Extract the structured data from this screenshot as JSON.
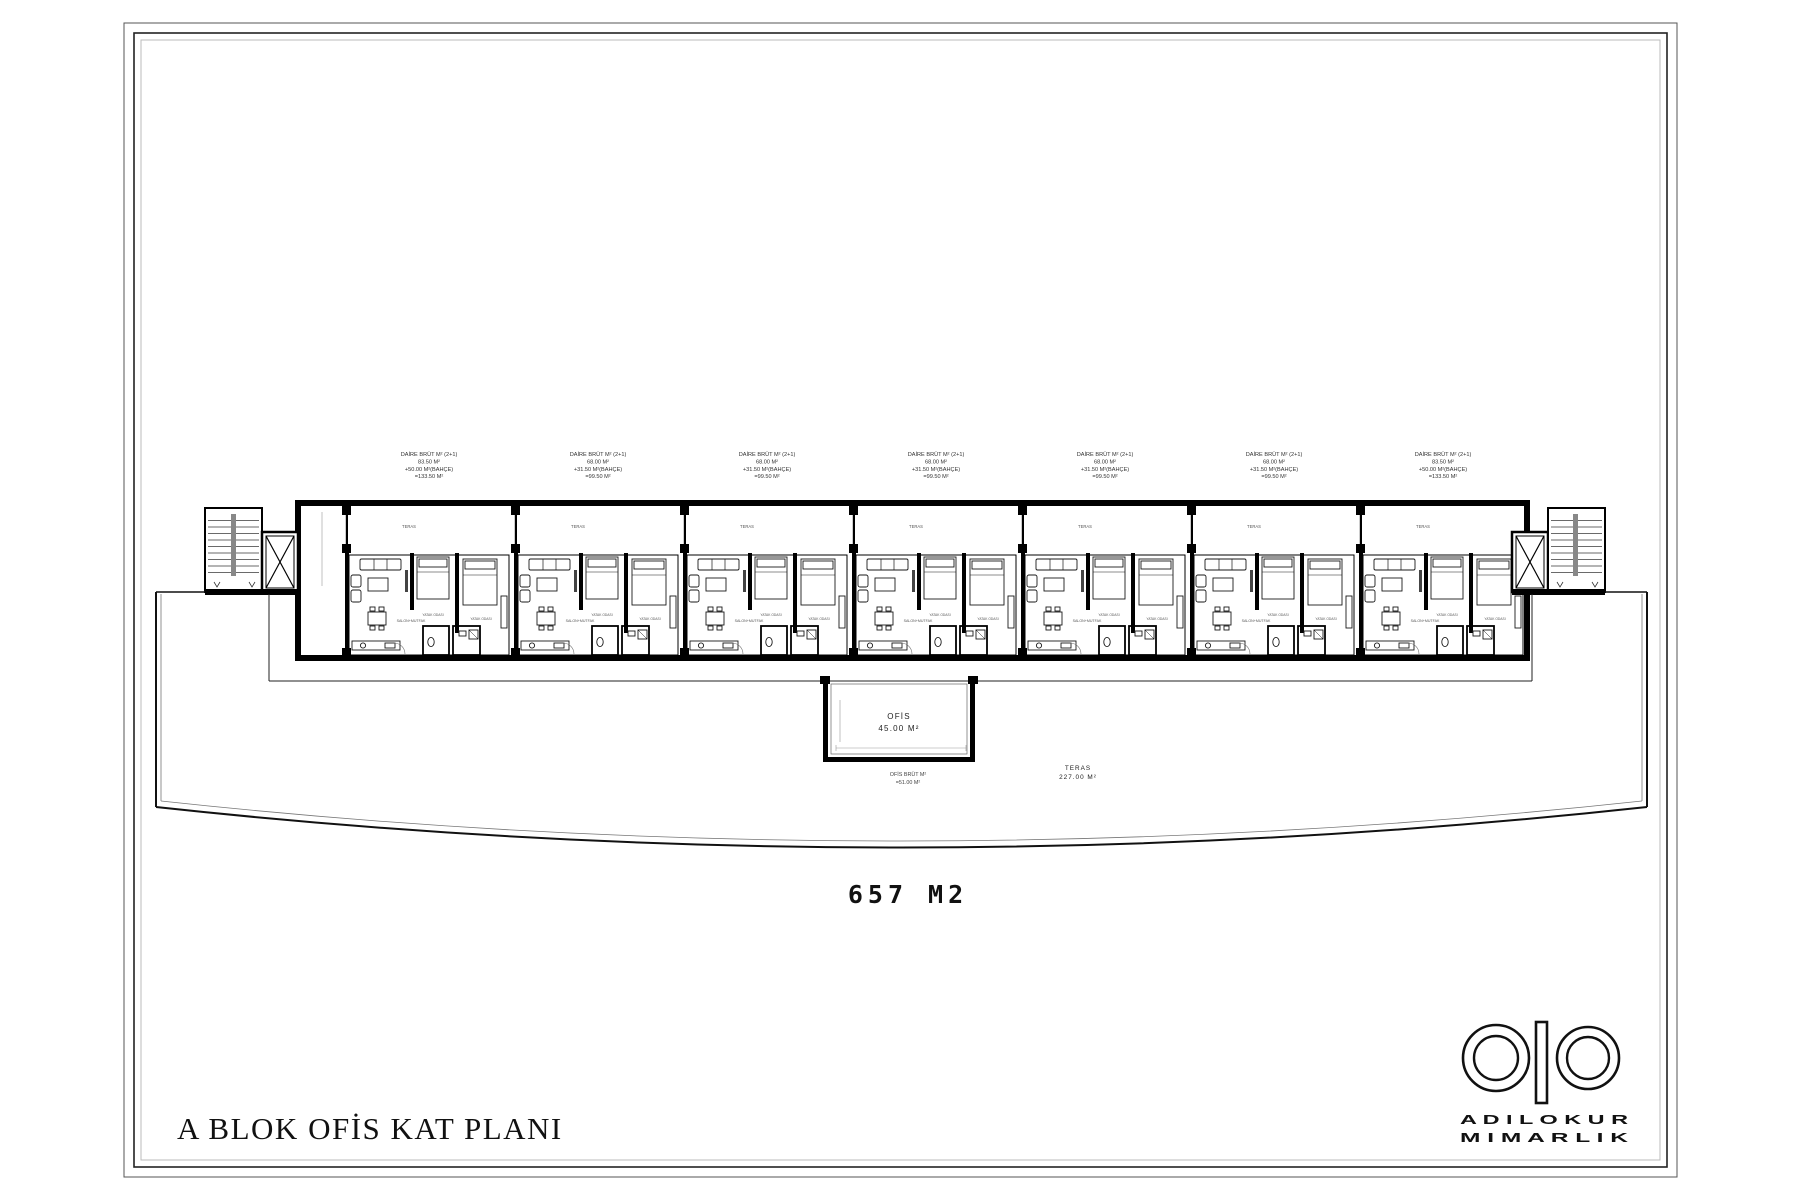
{
  "page": {
    "title": "A BLOK OFİS KAT PLANI",
    "total_area": "657 M2"
  },
  "logo": {
    "monogram": "ao",
    "line1": "A D I L O K U R",
    "line2": "M I M A R L I K"
  },
  "colors": {
    "ink": "#000000",
    "paper": "#ffffff",
    "faint_line": "#999999",
    "text": "#333333"
  },
  "plan": {
    "unit_count": 7,
    "unit_pitch_px": 169,
    "unit_labels": [
      [
        "DAİRE BRÜT M² (2+1)",
        "83.50 M²",
        "+50.00 M²(BAHÇE)",
        "=133.50 M²"
      ],
      [
        "DAİRE BRÜT M² (2+1)",
        "68.00 M²",
        "+31.50 M²(BAHÇE)",
        "=99.50 M²"
      ],
      [
        "DAİRE BRÜT M² (2+1)",
        "68.00 M²",
        "+31.50 M²(BAHÇE)",
        "=99.50 M²"
      ],
      [
        "DAİRE BRÜT M² (2+1)",
        "68.00 M²",
        "+31.50 M²(BAHÇE)",
        "=99.50 M²"
      ],
      [
        "DAİRE BRÜT M² (2+1)",
        "68.00 M²",
        "+31.50 M²(BAHÇE)",
        "=99.50 M²"
      ],
      [
        "DAİRE BRÜT M² (2+1)",
        "68.00 M²",
        "+31.50 M²(BAHÇE)",
        "=99.50 M²"
      ],
      [
        "DAİRE BRÜT M² (2+1)",
        "83.50 M²",
        "+50.00 M²(BAHÇE)",
        "=133.50 M²"
      ]
    ],
    "room_labels": {
      "living": "SALON+MUTFAK",
      "bedroom1": "YATAK ODASI",
      "bedroom2": "YATAK ODASI",
      "terrace_bay": "TERAS"
    },
    "ofis": {
      "name": "OFİS",
      "area": "45.00 M²",
      "brut_label": "OFİS BRÜT M²",
      "brut_total": "=51.00 M²"
    },
    "teras": {
      "name": "TERAS",
      "area": "227.00 M²"
    }
  }
}
